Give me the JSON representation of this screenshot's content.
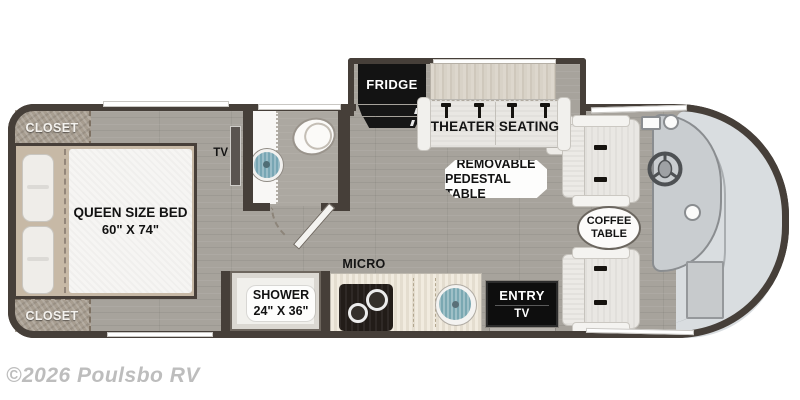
{
  "watermark": "©2026 Poulsbo RV",
  "bedroom": {
    "closet_top": "CLOSET",
    "closet_bottom": "CLOSET",
    "bed_name": "QUEEN SIZE BED",
    "bed_size": "60\" X 74\"",
    "tv": "TV"
  },
  "bathroom": {
    "shower_name": "SHOWER",
    "shower_size": "24\" X 36\""
  },
  "kitchen": {
    "fridge": "FRIDGE",
    "micro": "MICRO"
  },
  "living": {
    "theater_seating": "THEATER SEATING",
    "pedestal_line1": "REMOVABLE",
    "pedestal_line2": "PEDESTAL TABLE",
    "coffee_line1": "COFFEE",
    "coffee_line2": "TABLE",
    "entry": "ENTRY",
    "entry_tv": "TV"
  },
  "colors": {
    "wall": "#463f39",
    "floor": "#a7a39c",
    "closet_fabric": "#a79d90",
    "sink_blue": "#7aa8b2",
    "windshield": "#d9dde0",
    "appliance_black": "#131313",
    "watermark_gray": "#bdbdbd"
  }
}
